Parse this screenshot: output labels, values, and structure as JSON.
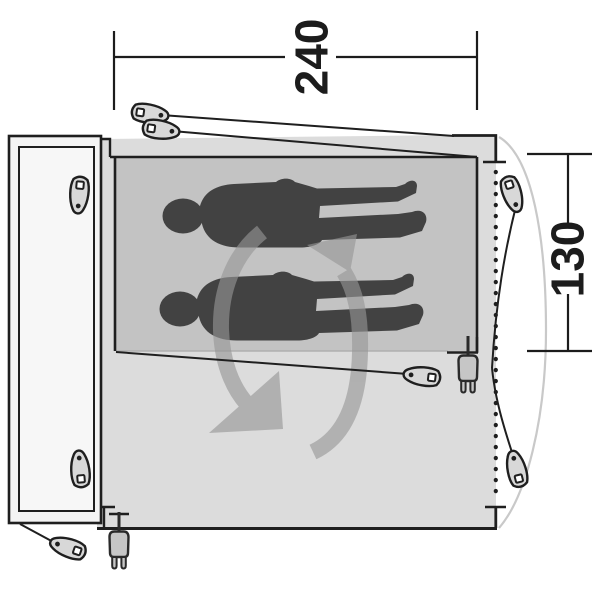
{
  "diagram": {
    "name": "tent-floorplan-top-view",
    "width_label": "240",
    "depth_label": "130",
    "people_count": 2,
    "peg_count": 8,
    "plug_count": 2
  },
  "colors": {
    "outline": "#1f1f1f",
    "tent_body": "#dcdcdc",
    "inner_cabin": "#c3c3c3",
    "door_flap": "#f4f4f4",
    "door_flap_inner": "#f7f7f7",
    "silhouette": "#424242",
    "rotation_arrow": "#969696",
    "peg_fill": "#d8d8d8",
    "plug_fill": "#c6c6c6",
    "door_arc": "#c9c9c9",
    "cabin_edge": "#b0b0b0"
  }
}
